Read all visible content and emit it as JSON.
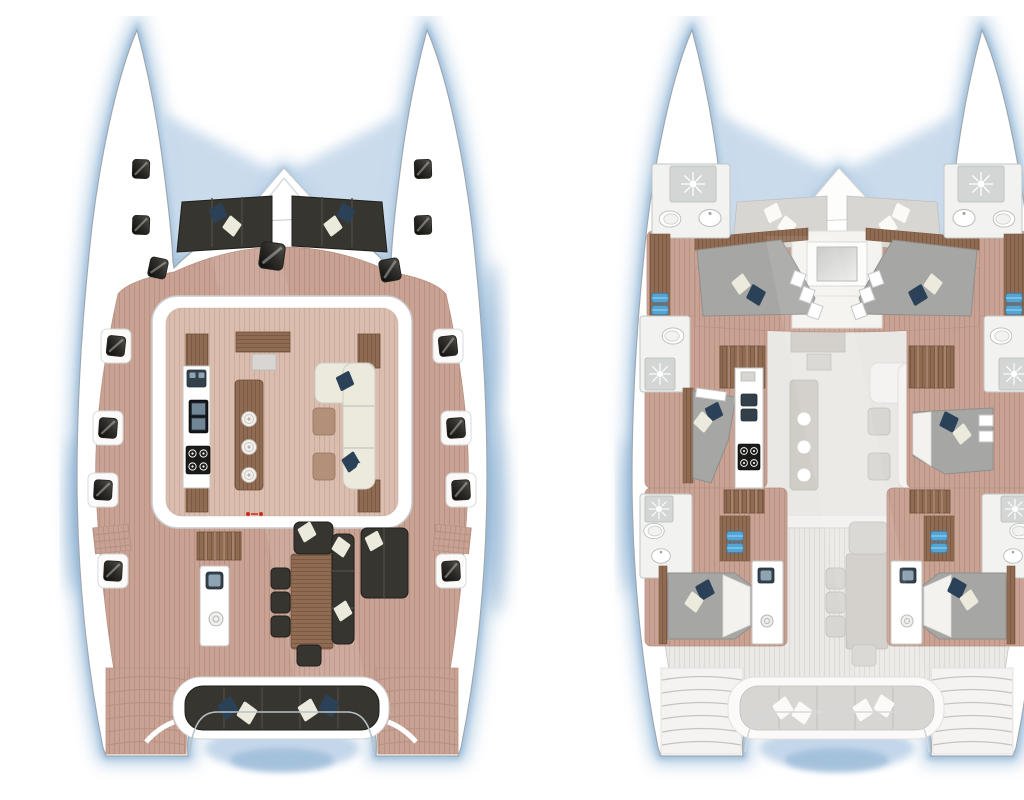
{
  "figure": {
    "type": "catamaran-yacht-deck-plans",
    "views": [
      {
        "label": "upper deck plan",
        "position": "left",
        "areas": [
          "bow seat pads",
          "trampoline",
          "foredeck with hatches",
          "salon",
          "galley counter",
          "island counter",
          "lounge sofa with ottomans",
          "companionway steps",
          "wet bar",
          "cockpit dining table with chairs",
          "cockpit l-bench",
          "sun lounger",
          "aft bench with pillows",
          "transom steps"
        ]
      },
      {
        "label": "lower deck plan (upper deck ghosted)",
        "position": "right",
        "areas": [
          "forward cabin port",
          "forward cabin starboard",
          "forward bathrooms with shower and toilet",
          "mid cabin port with galley counter",
          "mid cabin starboard",
          "mid bathrooms",
          "companionway stairs",
          "aft cabin port",
          "aft cabin starboard",
          "aft bathrooms",
          "towel shelves",
          "ghosted salon and cockpit"
        ]
      }
    ],
    "icons": [
      "deck-hatch-icon",
      "pillow-icon",
      "shower-sunburst-icon",
      "toilet-icon",
      "sink-icon",
      "stove-burner-icon",
      "island-hob-icon",
      "towel-icon"
    ]
  },
  "palette": {
    "hull": "#ffffff",
    "hullline": "#9fa8b0",
    "glow": "#9dbfdc",
    "glowdeep": "#6f9cc6",
    "water": "#bed3e8",
    "waterdeep": "#9dbcd9",
    "deck": "#c9a294",
    "deckline": "#b79282",
    "salonfloor": "#dabdaf",
    "salonfloorline": "#cbab9c",
    "dark": "#37352f",
    "darkline": "#1f1e1b",
    "seam": "#4d4a43",
    "navy": "#2b4157",
    "cream": "#eceadd",
    "wood": "#8e6b52",
    "woodline": "#7c5a42",
    "wooddark": "#6e4f3a",
    "oak": "#b2907a",
    "counter": "#ffffff",
    "counterline": "#c6c6c2",
    "steel": "#8ea4b2",
    "steeldark": "#33404a",
    "stove": "#1b1b19",
    "ghost": "#d8d6d2",
    "ghostline": "#c6c4c0",
    "ghostdeck": "#ebe9e6",
    "ghostdeckline": "#dddad6",
    "ghostwhite": "#f4f3f1",
    "mattress": "#a6a6a4",
    "mattressline": "#8f8f8d",
    "sheet": "#f3f2ee",
    "bath": "#f2f2f0",
    "bathline": "#c2c6c4",
    "shower": "#d3d6d4",
    "towel": "#54a4d4",
    "towelline": "#3d85b5",
    "red": "#cf2a1e"
  }
}
